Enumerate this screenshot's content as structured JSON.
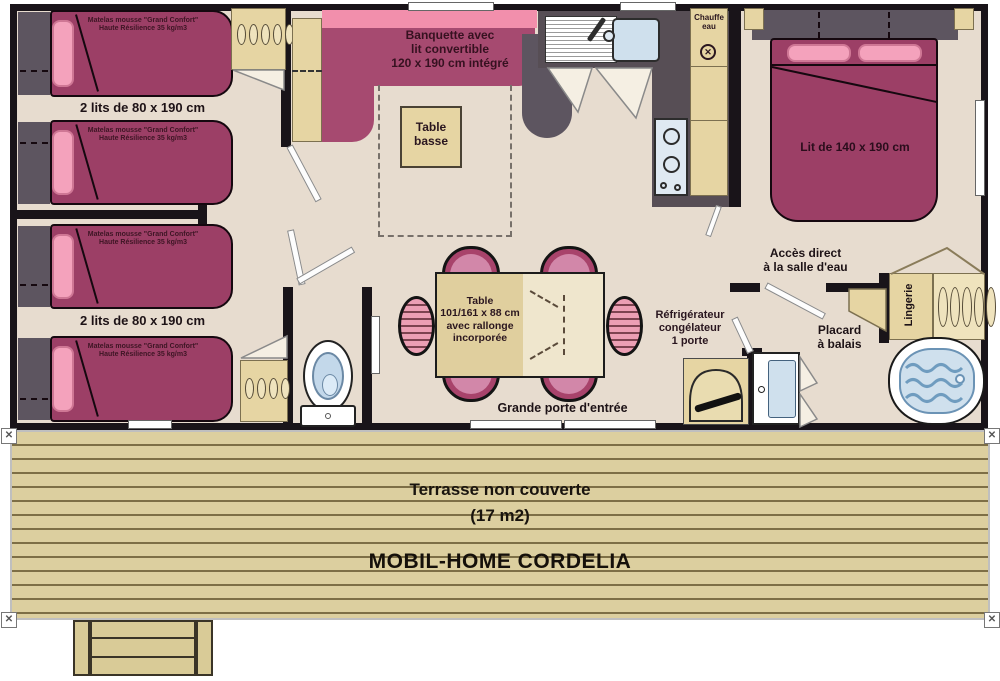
{
  "title": "MOBIL-HOME CORDELIA",
  "colors": {
    "wall": "#191419",
    "floor": "#e7dccf",
    "bed": "#9c3f66",
    "pillow": "#f4a2bc",
    "banquette_seat": "#a64a70",
    "banquette_back": "#f28fac",
    "wood": "#e6d5a3",
    "kitchen_counter": "#574e55",
    "water_blue": "#cfe0ed",
    "terrace": "#dccf9f",
    "label_text": "#2a161f"
  },
  "bedrooms_left": {
    "beds_label": "2 lits de 80 x 190 cm",
    "mattress_label": "Matelas mousse \"Grand Confort\"\nHaute Résilience 35 kg/m3"
  },
  "living": {
    "banquette_label": "Banquette avec\nlit convertible\n120 x 190 cm intégré",
    "coffee_table_label": "Table\nbasse",
    "dining_table_label": "Table\n101/161 x 88 cm\navec rallonge\nincorporée",
    "entry_label": "Grande porte d'entrée",
    "fridge_label": "Réfrigérateur\ncongélateur\n1 porte"
  },
  "kitchen": {
    "water_heater_label": "Chauffe\neau"
  },
  "master_bedroom": {
    "bed_label": "Lit de 140 x 190 cm"
  },
  "bathroom": {
    "access_label": "Accès direct\nà la salle d'eau",
    "broom_closet_label": "Placard\nà balais",
    "linen_label": "Lingerie"
  },
  "terrace": {
    "line1": "Terrasse non couverte",
    "line2": "(17 m2)",
    "title": "MOBIL-HOME CORDELIA"
  }
}
